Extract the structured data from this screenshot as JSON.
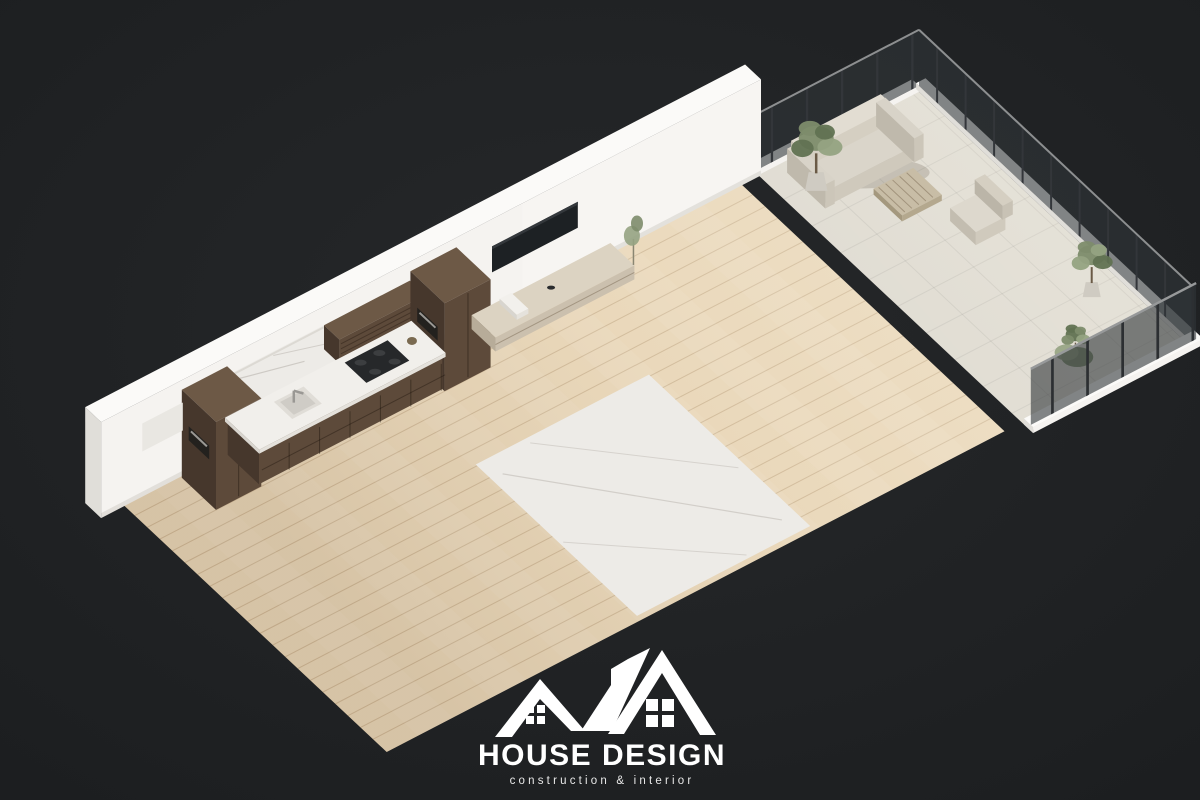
{
  "logo": {
    "title": "HOUSE DESIGN",
    "subtitle": "construction & interior"
  },
  "colors": {
    "background": "#1f2123",
    "backgroundCenter": "#26282a",
    "wall": "#f5f3f0",
    "wallTop": "#fbfaf8",
    "wallShade": "#e0ded9",
    "wallDark": "#d2d0cb",
    "floorWood": "#e8d5b6",
    "floorWoodDark": "#d9c2a0",
    "marble": "#edebe7",
    "marbleVein": "#c7c3bd",
    "cabinetWood": "#5d4a3a",
    "cabinetWoodLight": "#6d5946",
    "cabinetWoodDark": "#46372c",
    "counterMarble": "#f1efeb",
    "glassSmoke": "rgba(48,54,57,0.60)",
    "glassClear": "rgba(175,192,198,0.18)",
    "metalFrame": "#4a443e",
    "chrome": "#9a9894",
    "sofa": "#cfc5b2",
    "sofaDark": "#b9ae99",
    "rug": "#cdc6b8",
    "bedding": "#edebe7",
    "blanketGrey": "#a9a49c",
    "blanketBeige": "#c3b49b",
    "headboard": "#cfc6b8",
    "stone": "#d9d5cc",
    "plantGreen": "#7d8c6b",
    "plantGreenDark": "#617252",
    "plantGreenLight": "#95a382",
    "potClay": "#cfcbc2",
    "lampBlack": "#26282a",
    "tvScreen": "#1d2124",
    "white": "#ffffff"
  }
}
